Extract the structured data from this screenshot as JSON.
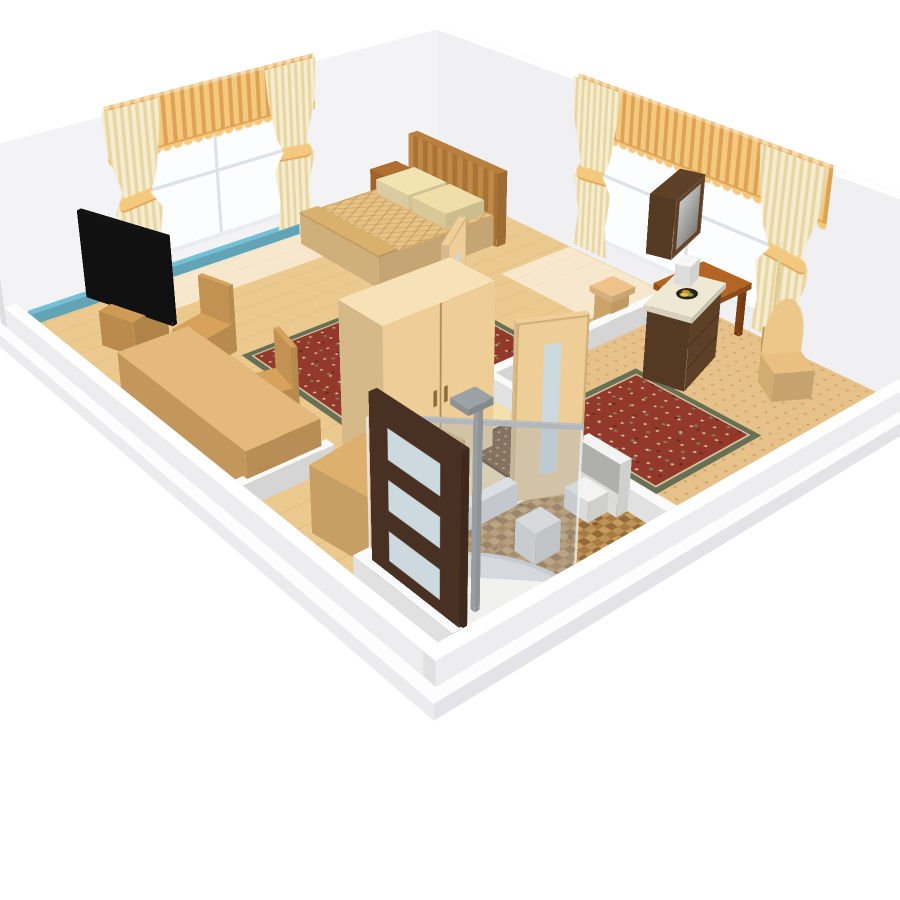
{
  "meta": {
    "view": "3d-floorplan-render",
    "background": "#ffffff"
  },
  "palette": {
    "wood": "#ecca8f",
    "carpet": "#e6c189",
    "carpetdot": "#d2a262",
    "rug": "#93392c",
    "rugborder": "#667055",
    "rugcream": "#d8c9a3",
    "ruggreen": "#7c8465",
    "curtain": "#f5ecce",
    "curtainsh": "#e7d6a4",
    "valance": "#f4c87d",
    "valancesh": "#dda254",
    "spread": "#e6c287",
    "woodlight": "#eecd97",
    "darkfurn": "#5d4026",
    "doordark": "#483122",
    "pane": "#ccd9df",
    "heater": "#74c0d6",
    "tv": "#131313",
    "fixture": "#f3f3f1",
    "fixturegrey": "#9ba1a5",
    "wall": "#f7f7f9",
    "slab": "#fbfbfc"
  },
  "camera": {
    "perspective": "1500px",
    "origin": "430px 230px",
    "left": "442px",
    "top": "360px",
    "rx": "64.5deg",
    "rz": "-40deg",
    "tx": "-290px",
    "ty": "-340px"
  },
  "shade": {
    "t": 1,
    "n": 0.96,
    "s": 0.85,
    "e": 0.72,
    "w": 0.9
  },
  "objects": [
    {
      "name": "platform-slab",
      "i": false,
      "x": -26,
      "y": -26,
      "z": -16,
      "k": "box",
      "w": 622,
      "d": 728,
      "h": 16,
      "c": "#fbfbfc",
      "fc": {
        "s": "#e4e4e8",
        "e": "#dedee2",
        "w": "#ececef",
        "n": "#f0f0f2",
        "t": "#fdfdfe"
      }
    },
    {
      "name": "floor-wood-bedroom",
      "i": false,
      "x": 0,
      "y": 0,
      "z": 0.4,
      "k": "floor",
      "w": 570,
      "d": 556,
      "cls": {
        "t": "f-wood"
      }
    },
    {
      "name": "floor-hallway",
      "i": false,
      "x": 96,
      "y": 410,
      "z": 0.7,
      "k": "floor",
      "w": 188,
      "d": 146,
      "c": "#f4dfae"
    },
    {
      "name": "floor-glow-window1",
      "i": false,
      "x": 120,
      "y": 2,
      "z": 0.9,
      "k": "floor",
      "w": 260,
      "d": 76,
      "cls": {
        "t": "f-glow"
      }
    },
    {
      "name": "floor-glow-window2",
      "i": false,
      "x": 462,
      "y": 240,
      "z": 0.9,
      "k": "floor",
      "w": 106,
      "d": 330,
      "cls": {
        "t": "f-glow"
      }
    },
    {
      "name": "carpet-living-room",
      "i": false,
      "x": 284,
      "y": 422,
      "z": 1.1,
      "k": "floor",
      "w": 286,
      "d": 254,
      "cls": {
        "t": "f-carpet"
      }
    },
    {
      "name": "floor-bathroom-tile",
      "i": false,
      "x": 24,
      "y": 556,
      "z": 1.1,
      "k": "floor",
      "w": 222,
      "d": 120,
      "cls": {
        "t": "f-tile"
      }
    },
    {
      "name": "rug-bedroom",
      "i": true,
      "x": 140,
      "y": 206,
      "z": 1.9,
      "k": "floor",
      "w": 230,
      "d": 204,
      "cls": {
        "t": "f-rug"
      }
    },
    {
      "name": "rug-living-room",
      "i": true,
      "x": 282,
      "y": 478,
      "z": 1.9,
      "k": "floor",
      "w": 128,
      "d": 142,
      "cls": {
        "t": "f-rug"
      }
    },
    {
      "name": "rug-hall-runner",
      "i": true,
      "x": 200,
      "y": 468,
      "z": 1.9,
      "k": "floor",
      "w": 58,
      "d": 72,
      "cls": {
        "t": "f-runner"
      }
    },
    {
      "name": "wall-northwest",
      "i": false,
      "x": -14,
      "y": -14,
      "k": "box",
      "w": 598,
      "d": 14,
      "h": 202,
      "c": "#f7f7f9",
      "fc": {
        "s": "#f3f3f6",
        "t": "#ffffff"
      }
    },
    {
      "name": "wall-northeast",
      "i": false,
      "x": 570,
      "y": -14,
      "k": "box",
      "w": 14,
      "d": 704,
      "h": 202,
      "c": "#f7f7f9",
      "fc": {
        "w": "#f0f0f3",
        "t": "#ffffff"
      }
    },
    {
      "name": "wall-southwest-low",
      "i": false,
      "x": -14,
      "y": 0,
      "k": "box",
      "w": 14,
      "d": 690,
      "h": 24,
      "c": "#fafafb",
      "fc": {
        "t": "#ffffff",
        "w": "#ededf0"
      }
    },
    {
      "name": "wall-southeast-low",
      "i": false,
      "x": -14,
      "y": 676,
      "k": "box",
      "w": 598,
      "d": 14,
      "h": 24,
      "c": "#fafafb",
      "fc": {
        "t": "#ffffff",
        "s": "#ededf0"
      }
    },
    {
      "name": "baseboard-heater-blue",
      "i": true,
      "x": 10,
      "y": 2,
      "k": "box",
      "w": 340,
      "d": 10,
      "h": 13,
      "c": "#74c0d6"
    },
    {
      "name": "window-1",
      "i": true,
      "x": 140,
      "y": 1.5,
      "z": 24,
      "k": "wy",
      "w": 220,
      "h": 164,
      "cls": {
        "s": "f-window"
      }
    },
    {
      "name": "valance-window-1",
      "i": true,
      "x": 118,
      "y": 4,
      "z": 152,
      "k": "wy",
      "w": 266,
      "h": 62,
      "cls": {
        "s": "f-valance"
      }
    },
    {
      "name": "curtain-1-left",
      "i": true,
      "x": 112,
      "y": 7,
      "z": 10,
      "k": "wy",
      "w": 72,
      "h": 200,
      "cls": {
        "s": "f-curtain c-l"
      }
    },
    {
      "name": "curtain-1-right",
      "i": true,
      "x": 314,
      "y": 7,
      "z": 10,
      "k": "wy",
      "w": 72,
      "h": 200,
      "cls": {
        "s": "f-curtain c-r"
      }
    },
    {
      "name": "window-2",
      "i": true,
      "x": 568.5,
      "y": 266,
      "z": 24,
      "k": "wx",
      "d": 290,
      "h": 164,
      "cls": {
        "e": "f-window"
      }
    },
    {
      "name": "valance-window-2",
      "i": true,
      "x": 566,
      "y": 244,
      "z": 152,
      "k": "wx",
      "d": 336,
      "h": 62,
      "cls": {
        "e": "f-valance"
      }
    },
    {
      "name": "curtain-2-left",
      "i": true,
      "x": 564,
      "y": 238,
      "z": 10,
      "k": "wx",
      "d": 74,
      "h": 200,
      "cls": {
        "e": "f-curtain c-l"
      }
    },
    {
      "name": "curtain-2-right",
      "i": true,
      "x": 564,
      "y": 494,
      "z": 10,
      "k": "wx",
      "d": 84,
      "h": 200,
      "cls": {
        "e": "f-curtain c-r"
      }
    },
    {
      "name": "bed",
      "i": true,
      "x": 336,
      "y": 34,
      "parts": [
        {
          "k": "box",
          "w": 170,
          "d": 146,
          "h": 38,
          "c": "#e6c287",
          "cls": {
            "t": "f-spread"
          }
        },
        {
          "k": "box",
          "px": 168,
          "py": -8,
          "w": 14,
          "d": 160,
          "h": 92,
          "c": "#b97f3e",
          "cls": {
            "w": "f-headboard"
          }
        },
        {
          "k": "box",
          "px": 104,
          "py": 10,
          "pz": 38,
          "w": 58,
          "d": 60,
          "h": 18,
          "c": "#f2e3b2"
        },
        {
          "k": "box",
          "px": 104,
          "py": 76,
          "pz": 38,
          "w": 58,
          "d": 60,
          "h": 18,
          "c": "#f0dea8"
        },
        {
          "k": "box",
          "px": 0,
          "py": 0,
          "pz": 38,
          "w": 26,
          "d": 146,
          "h": 3,
          "c": "#d9b06c"
        }
      ]
    },
    {
      "name": "nightstand",
      "i": true,
      "x": 462,
      "y": 4,
      "k": "box",
      "w": 40,
      "d": 28,
      "h": 50,
      "c": "#b06f2e"
    },
    {
      "name": "tv-on-stand",
      "i": true,
      "x": 44,
      "y": 96,
      "rot": -18,
      "parts": [
        {
          "k": "box",
          "w": 50,
          "d": 46,
          "h": 40,
          "c": "#cf9a55"
        },
        {
          "k": "box",
          "px": 18,
          "py": -34,
          "pz": 38,
          "w": 6,
          "d": 116,
          "h": 98,
          "c": "#131313",
          "cls": {
            "e": "f-tv-front"
          }
        }
      ]
    },
    {
      "name": "desk",
      "i": true,
      "x": 8,
      "y": 200,
      "k": "box",
      "w": 78,
      "d": 216,
      "h": 52,
      "c": "#d9a765",
      "fc": {
        "t": "#e5b97c"
      }
    },
    {
      "name": "chair-1",
      "i": true,
      "x": 88,
      "y": 164,
      "rot": -14,
      "parts": [
        {
          "k": "box",
          "w": 44,
          "d": 42,
          "h": 33,
          "c": "#d7a25c"
        },
        {
          "k": "box",
          "px": 40,
          "w": 6,
          "d": 42,
          "h": 76,
          "c": "#d7a25c"
        }
      ]
    },
    {
      "name": "chair-2",
      "i": true,
      "x": 84,
      "y": 284,
      "rot": 12,
      "parts": [
        {
          "k": "box",
          "w": 44,
          "d": 42,
          "h": 33,
          "c": "#d7a25c"
        },
        {
          "k": "box",
          "px": 40,
          "w": 6,
          "d": 42,
          "h": 76,
          "c": "#d7a25c"
        }
      ]
    },
    {
      "name": "storage-chest",
      "i": true,
      "x": 24,
      "y": 486,
      "rot": -8,
      "k": "box",
      "w": 112,
      "d": 70,
      "h": 68,
      "c": "#ddb06e"
    },
    {
      "name": "wardrobe",
      "i": true,
      "x": 100,
      "y": 428,
      "k": "box",
      "w": 124,
      "d": 60,
      "h": 170,
      "c": "#eecd97",
      "cls": {
        "s": "f-ward"
      },
      "fc": {
        "t": "#f6e2b6"
      }
    },
    {
      "name": "lowwall-mid-west",
      "i": false,
      "x": 0,
      "y": 410,
      "k": "box",
      "w": 96,
      "d": 12,
      "h": 24,
      "c": "#fafafb"
    },
    {
      "name": "lowwall-mid-east",
      "i": false,
      "x": 284,
      "y": 410,
      "k": "box",
      "w": 286,
      "d": 12,
      "h": 24,
      "c": "#fafafb"
    },
    {
      "name": "lowwall-hall-east",
      "i": false,
      "x": 278,
      "y": 422,
      "k": "box",
      "w": 10,
      "d": 100,
      "h": 24,
      "c": "#fafafb"
    },
    {
      "name": "lowwall-bath-north",
      "i": false,
      "x": 24,
      "y": 556,
      "k": "box",
      "w": 156,
      "d": 12,
      "h": 24,
      "c": "#fafafb"
    },
    {
      "name": "lowwall-bath-east",
      "i": false,
      "x": 246,
      "y": 556,
      "k": "box",
      "w": 12,
      "d": 120,
      "h": 24,
      "c": "#fafafb"
    },
    {
      "name": "lowwall-bath-west",
      "i": false,
      "x": 14,
      "y": 556,
      "k": "box",
      "w": 10,
      "d": 120,
      "h": 24,
      "c": "#fafafb"
    },
    {
      "name": "door-bathroom-dark",
      "i": true,
      "x": 22,
      "y": 570,
      "k": "box",
      "w": 8,
      "d": 104,
      "h": 178,
      "c": "#483122",
      "cls": {
        "w": "f-door-dark-face",
        "e": "f-door-dark-face"
      }
    },
    {
      "name": "door-hallway",
      "i": true,
      "x": 226,
      "y": 413,
      "rot": -34,
      "k": "box",
      "w": 62,
      "d": 7,
      "h": 176,
      "c": "#efce9a",
      "cls": {
        "s": "f-door-light-face"
      }
    },
    {
      "name": "door-bathroom-light",
      "i": true,
      "x": 182,
      "y": 556,
      "rot": 26,
      "k": "box",
      "w": 62,
      "d": 7,
      "h": 176,
      "c": "#efce9a",
      "cls": {
        "s": "f-door-light-face"
      }
    },
    {
      "name": "threshold-hall",
      "i": false,
      "x": 224,
      "y": 412,
      "z": 2,
      "k": "floor",
      "w": 62,
      "d": 10,
      "c": "#ffffff"
    },
    {
      "name": "threshold-bath",
      "i": false,
      "x": 180,
      "y": 558,
      "z": 2,
      "k": "floor",
      "w": 66,
      "d": 10,
      "c": "#ffffff"
    },
    {
      "name": "shower",
      "i": true,
      "x": 26,
      "y": 558,
      "parts": [
        {
          "k": "floor",
          "pz": 2,
          "w": 116,
          "d": 116,
          "cls": {
            "t": "f-shower-base"
          }
        },
        {
          "k": "box",
          "px": 34,
          "py": 86,
          "w": 5,
          "d": 5,
          "h": 188,
          "c": "#a8aeb3"
        },
        {
          "k": "box",
          "px": 24,
          "py": 72,
          "pz": 184,
          "w": 24,
          "d": 20,
          "h": 6,
          "c": "#9ba1a5"
        }
      ]
    },
    {
      "name": "shower-glass",
      "i": false,
      "x": 144,
      "y": 674,
      "rot": -135,
      "parts": [
        {
          "k": "wy",
          "w": 160,
          "h": 148,
          "cls": {
            "s": "f-glass"
          }
        },
        {
          "k": "box",
          "py": -2,
          "pz": 146,
          "w": 160,
          "d": 3,
          "h": 4,
          "c": "#b9bfc4"
        }
      ]
    },
    {
      "name": "toilet",
      "i": true,
      "x": 204,
      "y": 584,
      "parts": [
        {
          "k": "box",
          "px": 28,
          "w": 15,
          "d": 50,
          "h": 54,
          "c": "#f3f3f1"
        },
        {
          "k": "box",
          "px": 4,
          "py": 12,
          "w": 26,
          "d": 28,
          "h": 22,
          "c": "#f3f3f1"
        },
        {
          "k": "floor",
          "px": -4,
          "py": 4,
          "pz": 24,
          "w": 40,
          "d": 44,
          "c": "#f3f3f1",
          "cls": {
            "t": "f-disc"
          }
        },
        {
          "k": "floor",
          "px": 0,
          "py": 8,
          "pz": 26,
          "w": 32,
          "d": 36,
          "c": "#9ba1a5",
          "cls": {
            "t": "f-disc"
          }
        },
        {
          "k": "wx",
          "px": 27,
          "py": 6,
          "pz": 26,
          "d": 46,
          "h": 30,
          "c": "#f3f3f1"
        }
      ]
    },
    {
      "name": "bidet",
      "i": true,
      "x": 136,
      "y": 612,
      "parts": [
        {
          "k": "box",
          "w": 28,
          "d": 24,
          "h": 32,
          "c": "#f3f3f1"
        },
        {
          "k": "floor",
          "px": -3,
          "py": -3,
          "pz": 33,
          "w": 34,
          "d": 30,
          "c": "#9ba1a5",
          "cls": {
            "t": "f-disc"
          }
        },
        {
          "k": "floor",
          "px": 2,
          "py": 1,
          "pz": 34,
          "w": 22,
          "d": 18,
          "c": "#f3f3f1",
          "cls": {
            "t": "f-disc"
          }
        }
      ]
    },
    {
      "name": "dresser",
      "i": true,
      "x": 415,
      "y": 495,
      "rot": -18,
      "parts": [
        {
          "k": "box",
          "w": 78,
          "d": 44,
          "h": 78,
          "c": "#5d4026",
          "cls": {
            "s": "f-drawers"
          }
        },
        {
          "k": "box",
          "px": -3,
          "py": -3,
          "pz": 78,
          "w": 84,
          "d": 50,
          "h": 6,
          "c": "#efe8d2"
        },
        {
          "k": "floor",
          "px": 26,
          "py": 14,
          "pz": 85,
          "w": 24,
          "d": 20,
          "cls": {
            "t": "f-fruitbowl"
          }
        },
        {
          "k": "box",
          "px": 52,
          "py": 4,
          "pz": 84,
          "w": 24,
          "d": 16,
          "h": 22,
          "c": "#f6f6f4"
        }
      ]
    },
    {
      "name": "wall-cabinet",
      "i": true,
      "x": 420,
      "y": 484,
      "z": 132,
      "rot": -18,
      "k": "box",
      "w": 70,
      "d": 26,
      "h": 62,
      "c": "#5d4026",
      "cls": {
        "s": "f-glasscab"
      }
    },
    {
      "name": "side-table",
      "i": true,
      "x": 486,
      "y": 440,
      "parts": [
        {
          "k": "box",
          "pz": 54,
          "w": 76,
          "d": 64,
          "h": 7,
          "c": "#a3591d",
          "fc": {
            "t": "#b46524"
          }
        },
        {
          "k": "box",
          "px": 3,
          "py": 3,
          "w": 6,
          "d": 6,
          "h": 54,
          "c": "#8a4517"
        },
        {
          "k": "box",
          "px": 67,
          "py": 3,
          "w": 6,
          "d": 6,
          "h": 54,
          "c": "#8a4517"
        },
        {
          "k": "box",
          "px": 3,
          "py": 55,
          "w": 6,
          "d": 6,
          "h": 54,
          "c": "#8a4517"
        },
        {
          "k": "box",
          "px": 67,
          "py": 55,
          "w": 6,
          "d": 6,
          "h": 54,
          "c": "#8a4517"
        }
      ]
    },
    {
      "name": "pedestal-stand",
      "i": true,
      "x": 452,
      "y": 384,
      "parts": [
        {
          "k": "box",
          "w": 34,
          "d": 32,
          "h": 7,
          "c": "#e3b574"
        },
        {
          "k": "box",
          "px": 4,
          "py": 4,
          "w": 26,
          "d": 24,
          "h": 46,
          "c": "#e3b574"
        },
        {
          "k": "box",
          "pz": 40,
          "w": 34,
          "d": 32,
          "h": 7,
          "c": "#eec38a"
        }
      ]
    },
    {
      "name": "accent-chair",
      "i": true,
      "x": 498,
      "y": 570,
      "rot": 32,
      "parts": [
        {
          "k": "box",
          "w": 40,
          "d": 38,
          "h": 32,
          "c": "#e9c07f"
        },
        {
          "k": "wy",
          "py": 2,
          "pz": 30,
          "w": 40,
          "h": 62,
          "cls": {
            "s": "f-chairback"
          }
        }
      ]
    },
    {
      "name": "dried-plant",
      "i": true,
      "x": 541,
      "y": 540,
      "rot": -40,
      "parts": [
        {
          "k": "box",
          "w": 20,
          "d": 18,
          "h": 24,
          "c": "#cf9a55"
        },
        {
          "k": "wy",
          "px": -30,
          "py": 8,
          "pz": 20,
          "w": 80,
          "h": 104,
          "cls": {
            "s": "f-plume"
          }
        }
      ]
    }
  ]
}
